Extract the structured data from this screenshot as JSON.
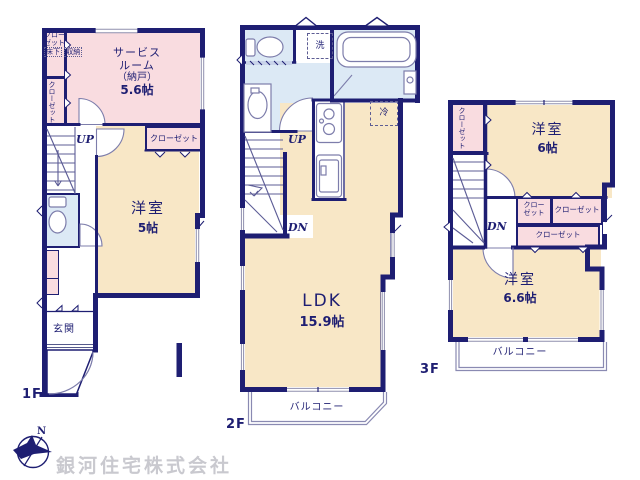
{
  "colors": {
    "wall_navy": "#1e1e72",
    "room_cream": "#f8e7c6",
    "room_pink": "#f9dce0",
    "wet_area_blue": "#dce9f5",
    "watermark_gray": "#c9c9cf"
  },
  "compass": {
    "north_label": "N"
  },
  "company": {
    "name": "銀河住宅株式会社"
  },
  "floor1": {
    "label": "1F",
    "service_room": {
      "line1": "サービス",
      "line2": "ルーム",
      "line3": "（納戸）",
      "size": "5.6帖"
    },
    "closet_hatch": {
      "line1": "クロー",
      "line2": "ゼット",
      "line3": "床下",
      "line4": "収納"
    },
    "closet_side": "クローゼット",
    "bedroom": {
      "name": "洋室",
      "size": "5帖"
    },
    "bedroom_closet": "クローゼット",
    "entrance": "玄関",
    "up": "UP"
  },
  "floor2": {
    "label": "2F",
    "ldk": {
      "name": "LDK",
      "size": "15.9帖"
    },
    "laundry": "洗",
    "fridge": "冷",
    "up": "UP",
    "down": "DN",
    "balcony": "バルコニー"
  },
  "floor3": {
    "label": "3F",
    "bedroom6": {
      "name": "洋室",
      "size": "6帖"
    },
    "bedroom66": {
      "name": "洋室",
      "size": "6.6帖"
    },
    "closet_side": "クローゼット",
    "closet_a": {
      "line1": "クロー",
      "line2": "ゼット"
    },
    "closet_b": "クローゼット",
    "closet_c": "クローゼット",
    "down": "DN",
    "balcony": "バルコニー"
  }
}
